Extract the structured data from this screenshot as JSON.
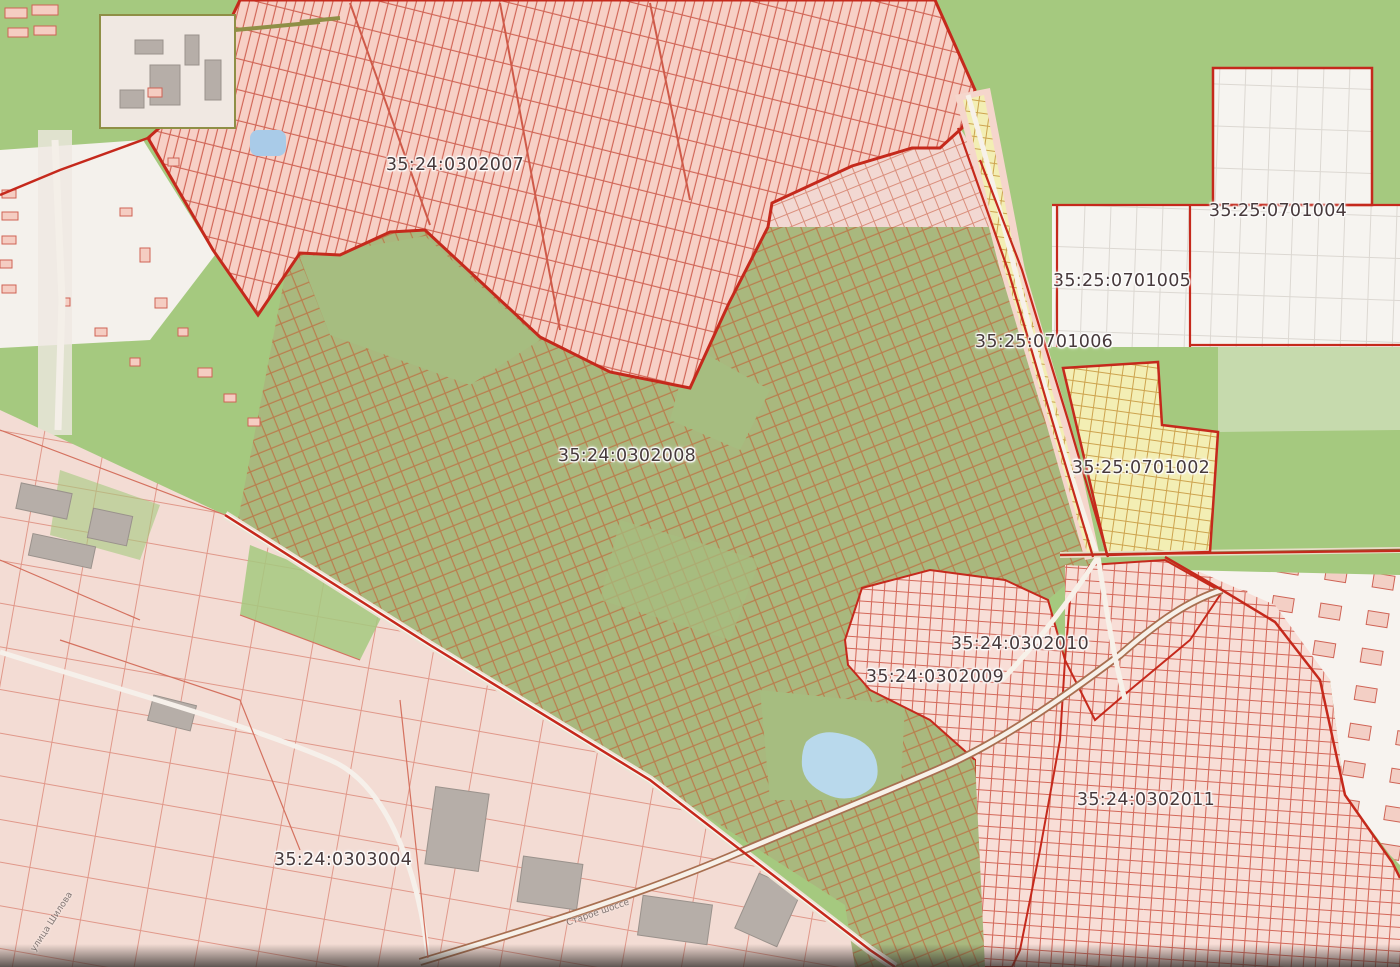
{
  "map": {
    "kind": "public-cadastral-map",
    "cadastral_labels": [
      {
        "text": "35:24:0302007"
      },
      {
        "text": "35:25:0701004"
      },
      {
        "text": "35:25:0701005"
      },
      {
        "text": "35:25:0701006"
      },
      {
        "text": "35:24:0302008"
      },
      {
        "text": "35:25:0701002"
      },
      {
        "text": "35:24:0302010"
      },
      {
        "text": "35:24:0302009"
      },
      {
        "text": "35:24:0302011"
      },
      {
        "text": "35:24:0303004"
      }
    ],
    "street_labels": [
      {
        "text": "улица Шилова"
      },
      {
        "text": "Старое шоссе"
      }
    ],
    "colors": {
      "field_green": "#a5c97f",
      "garden_olive": "#a9b87e",
      "dense_pink": "#f7d0c6",
      "urban_pink": "#f3dcd4",
      "parcel_yellow": "#f3eeb4",
      "white_block": "#f6f4f0",
      "boundary_red": "#c5291c",
      "pond_blue": "#b9d9ec",
      "label_text": "#473a3c"
    }
  }
}
